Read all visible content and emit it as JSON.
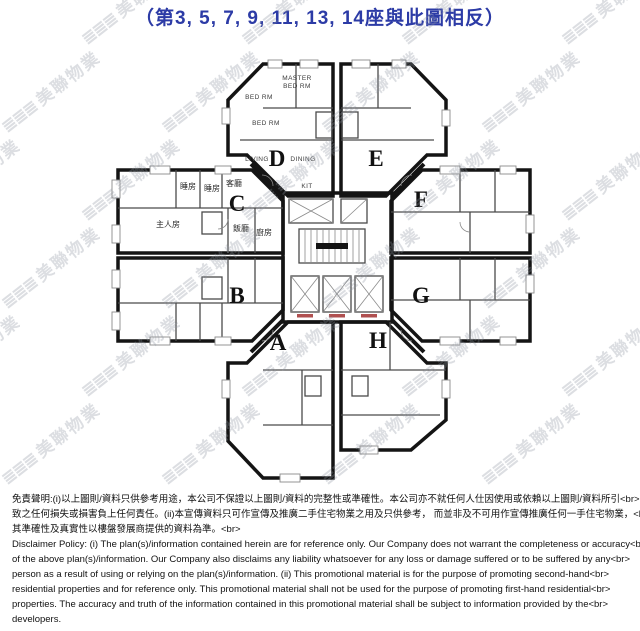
{
  "title": "（第3, 5, 7, 9, 11, 13, 14座與此圖相反）",
  "colors": {
    "title_blue": "#2c3ba6",
    "unit_cream": "#f6f1dd",
    "unit_blue": "#e2eaf3",
    "core_white": "#fbfaf6",
    "wall_black": "#141414",
    "watermark_gray": "#8d94a0"
  },
  "watermark": {
    "logo": "≣≣≣",
    "brand": "美聯物業"
  },
  "floor_plan": {
    "units": [
      {
        "id": "A",
        "fill": "blue",
        "label_x": 278,
        "label_y": 350
      },
      {
        "id": "B",
        "fill": "cream",
        "label_x": 237,
        "label_y": 303
      },
      {
        "id": "C",
        "fill": "blue",
        "label_x": 237,
        "label_y": 211
      },
      {
        "id": "D",
        "fill": "cream",
        "label_x": 277,
        "label_y": 166
      },
      {
        "id": "E",
        "fill": "blue",
        "label_x": 376,
        "label_y": 166
      },
      {
        "id": "F",
        "fill": "cream",
        "label_x": 421,
        "label_y": 207
      },
      {
        "id": "G",
        "fill": "blue",
        "label_x": 421,
        "label_y": 303
      },
      {
        "id": "H",
        "fill": "cream",
        "label_x": 378,
        "label_y": 348
      }
    ],
    "room_labels": [
      {
        "text": "BED RM",
        "x": 259,
        "y": 99,
        "lang": "en"
      },
      {
        "text": "MASTER",
        "x": 297,
        "y": 80,
        "lang": "en"
      },
      {
        "text": "BED RM",
        "x": 297,
        "y": 88,
        "lang": "en"
      },
      {
        "text": "BED RM",
        "x": 266,
        "y": 125,
        "lang": "en"
      },
      {
        "text": "LIVING",
        "x": 257,
        "y": 161,
        "lang": "en"
      },
      {
        "text": "DINING",
        "x": 303,
        "y": 161,
        "lang": "en"
      },
      {
        "text": "KIT",
        "x": 307,
        "y": 188,
        "lang": "en"
      },
      {
        "text": "睡房",
        "x": 188,
        "y": 189,
        "lang": "zh"
      },
      {
        "text": "睡房",
        "x": 212,
        "y": 191,
        "lang": "zh"
      },
      {
        "text": "客廳",
        "x": 234,
        "y": 186,
        "lang": "zh"
      },
      {
        "text": "主人房",
        "x": 168,
        "y": 227,
        "lang": "zh"
      },
      {
        "text": "飯廳",
        "x": 241,
        "y": 231,
        "lang": "zh"
      },
      {
        "text": "廚房",
        "x": 264,
        "y": 235,
        "lang": "zh"
      }
    ]
  },
  "disclaimer": {
    "lines": [
      "免責聲明:(i)以上圖則/資料只供參考用途，本公司不保證以上圖則/資料的完整性或準確性。本公司亦不就任何人仕因使用或依賴以上圖則/資料所引<br>",
      "致之任何損失或損害負上任何責任。(ii)本宣傳資料只可作宣傳及推廣二手住宅物業之用及只供參考， 而並非及不可用作宣傳推廣任何一手住宅物業，<br>",
      "其準確性及真實性以樓盤發展商提供的資料為準。<br>",
      "Disclaimer Policy: (i) The plan(s)/information contained herein are for reference only. Our Company does not warrant the completeness or accuracy<br>",
      "of the above plan(s)/information. Our Company also disclaims any liability whatsoever for any loss or damage suffered or to be suffered by any<br>",
      "person as a result of using or relying on the plan(s)/information. (ii) This promotional material is for the purpose of promoting second-hand<br>",
      "residential properties and for reference only. This promotional material shall not be used for the purpose of promoting first-hand residential<br>",
      "properties. The accuracy and truth of the information contained in this promotional material shall be subject to information provided by the<br>",
      "developers."
    ]
  }
}
